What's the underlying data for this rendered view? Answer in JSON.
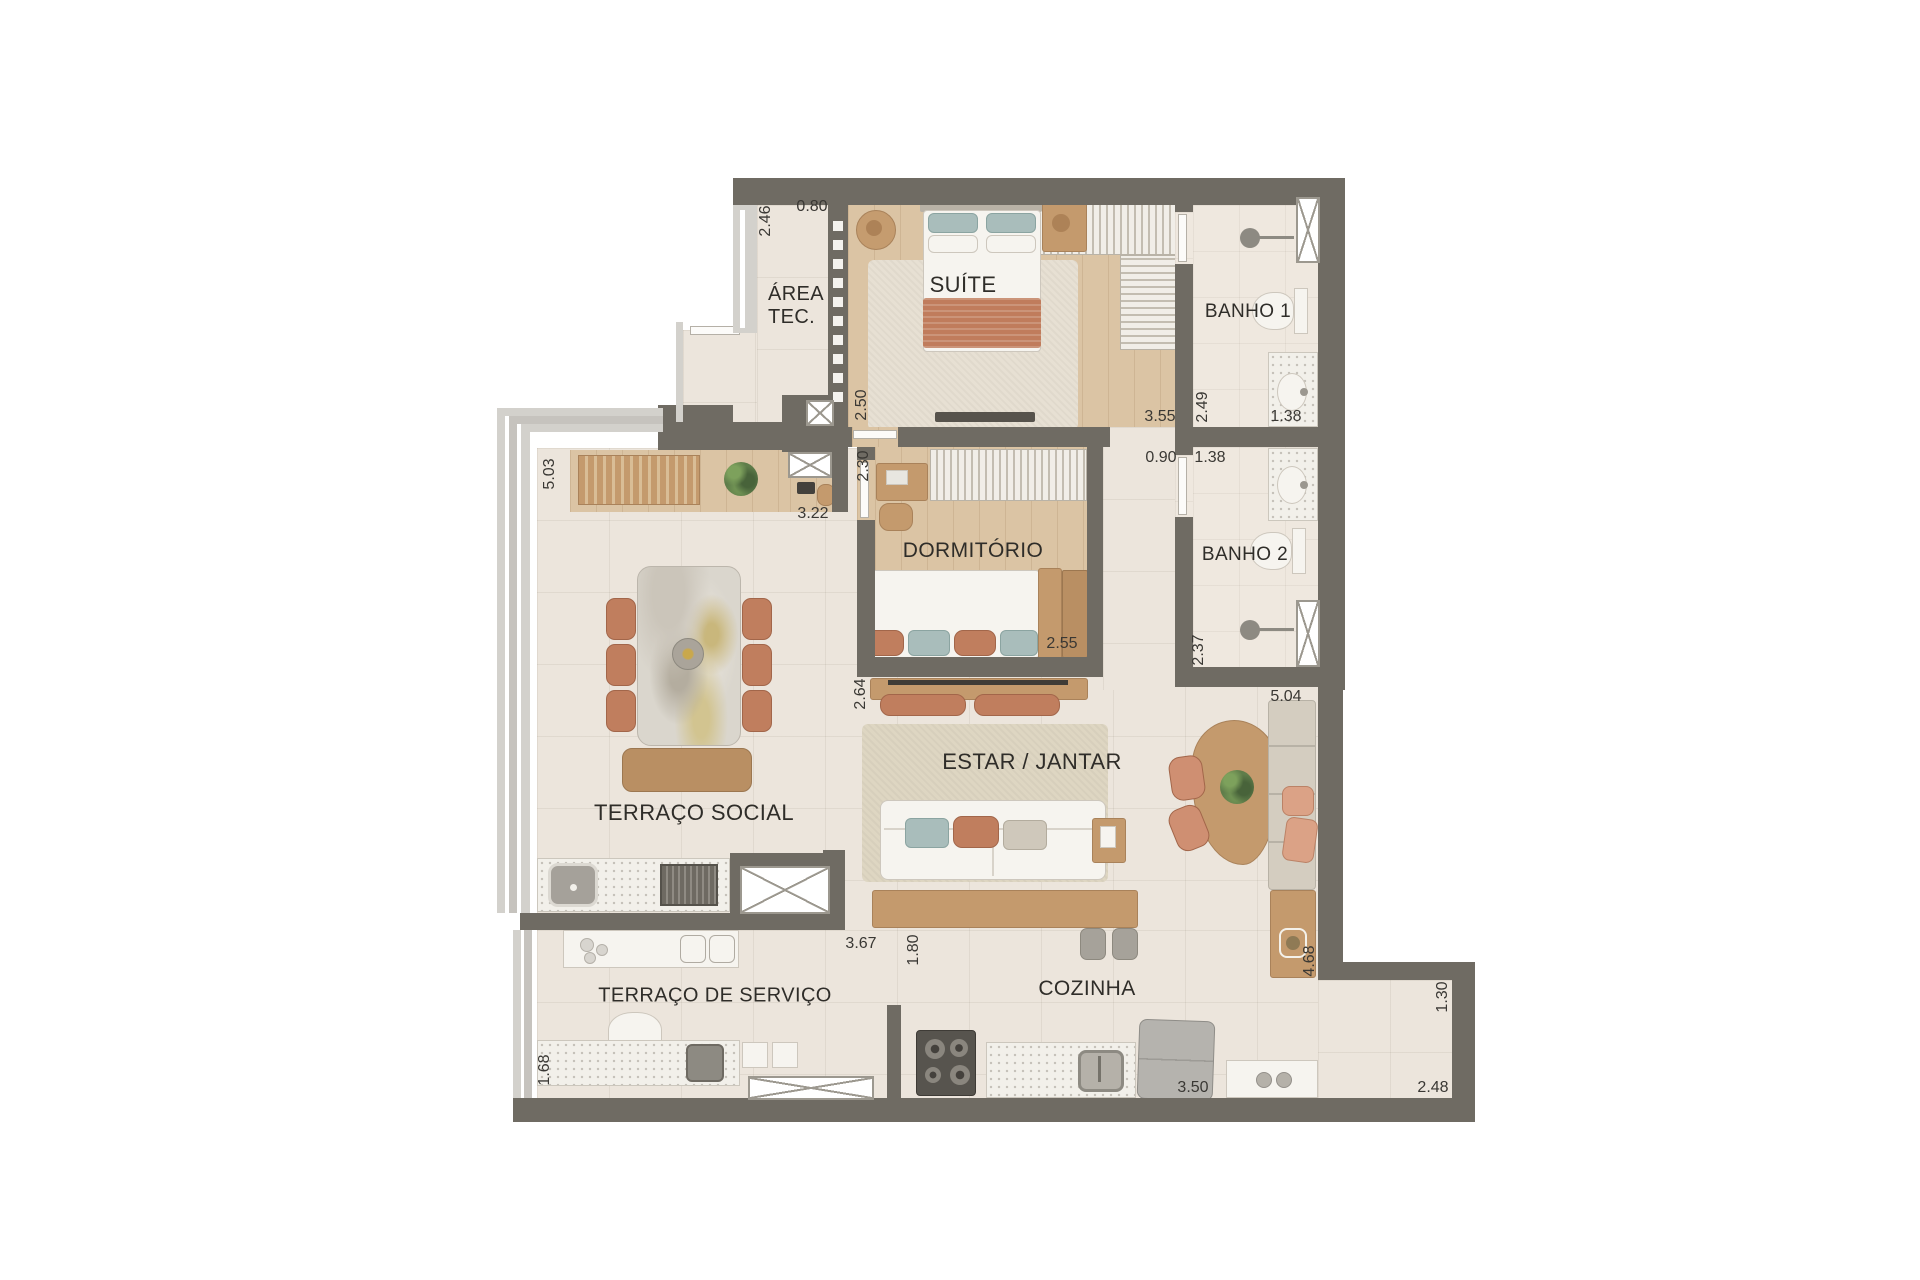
{
  "plan": {
    "title": "apartment-floor-plan",
    "rooms": [
      {
        "id": "area-tec",
        "label": "ÁREA\nTEC.",
        "x": 796,
        "y": 306,
        "size": 20,
        "align": "left"
      },
      {
        "id": "suite",
        "label": "SUÍTE",
        "x": 963,
        "y": 285,
        "size": 22,
        "align": "center"
      },
      {
        "id": "banho-1",
        "label": "BANHO 1",
        "x": 1248,
        "y": 312,
        "size": 19,
        "align": "center"
      },
      {
        "id": "dormitorio",
        "label": "DORMITÓRIO",
        "x": 973,
        "y": 551,
        "size": 21,
        "align": "center"
      },
      {
        "id": "banho-2",
        "label": "BANHO 2",
        "x": 1245,
        "y": 555,
        "size": 19,
        "align": "center"
      },
      {
        "id": "terraco-social",
        "label": "TERRAÇO SOCIAL",
        "x": 694,
        "y": 813,
        "size": 22,
        "align": "center"
      },
      {
        "id": "estar-jantar",
        "label": "ESTAR / JANTAR",
        "x": 1032,
        "y": 762,
        "size": 22,
        "align": "center"
      },
      {
        "id": "cozinha",
        "label": "COZINHA",
        "x": 1087,
        "y": 989,
        "size": 21,
        "align": "center"
      },
      {
        "id": "terraco-servico",
        "label": "TERRAÇO DE SERVIÇO",
        "x": 715,
        "y": 996,
        "size": 20,
        "align": "center"
      }
    ],
    "dimensions": [
      {
        "text": "2.46",
        "x": 766,
        "y": 221,
        "rot": -90
      },
      {
        "text": "0.80",
        "x": 812,
        "y": 207,
        "rot": 0
      },
      {
        "text": "2.50",
        "x": 862,
        "y": 405,
        "rot": -90
      },
      {
        "text": "3.55",
        "x": 1160,
        "y": 417,
        "rot": 0
      },
      {
        "text": "2.49",
        "x": 1203,
        "y": 407,
        "rot": -90
      },
      {
        "text": "1.38",
        "x": 1286,
        "y": 417,
        "rot": 0
      },
      {
        "text": "0.90",
        "x": 1161,
        "y": 458,
        "rot": 0
      },
      {
        "text": "1.38",
        "x": 1210,
        "y": 458,
        "rot": 0
      },
      {
        "text": "2.30",
        "x": 864,
        "y": 466,
        "rot": -90
      },
      {
        "text": "3.22",
        "x": 813,
        "y": 514,
        "rot": 0
      },
      {
        "text": "5.03",
        "x": 550,
        "y": 474,
        "rot": -90
      },
      {
        "text": "2.55",
        "x": 1062,
        "y": 644,
        "rot": 0
      },
      {
        "text": "2.64",
        "x": 861,
        "y": 694,
        "rot": -90
      },
      {
        "text": "2.37",
        "x": 1199,
        "y": 650,
        "rot": -90
      },
      {
        "text": "5.04",
        "x": 1286,
        "y": 697,
        "rot": 0
      },
      {
        "text": "3.67",
        "x": 861,
        "y": 944,
        "rot": 0
      },
      {
        "text": "1.80",
        "x": 914,
        "y": 950,
        "rot": -90
      },
      {
        "text": "1.68",
        "x": 545,
        "y": 1070,
        "rot": -90
      },
      {
        "text": "4.68",
        "x": 1310,
        "y": 961,
        "rot": -90
      },
      {
        "text": "3.50",
        "x": 1193,
        "y": 1088,
        "rot": 0
      },
      {
        "text": "1.30",
        "x": 1443,
        "y": 997,
        "rot": -90
      },
      {
        "text": "2.48",
        "x": 1433,
        "y": 1088,
        "rot": 0
      }
    ],
    "colors": {
      "wall": "#6f6b63",
      "tile": "#ece5dc",
      "bath_tile": "#efe8df",
      "wood_floor": "#dbc4a4",
      "wood": "#c49a6d",
      "wood_dark": "#b98f63",
      "terracotta": "#c07e5e",
      "teal": "#a9bdbb",
      "white_furniture": "#f6f4ef",
      "rug": "#e7e0d3",
      "frame_gray": "#d3d1cc",
      "label_text": "#2f2d29",
      "dimension_text": "#3a3834"
    }
  }
}
